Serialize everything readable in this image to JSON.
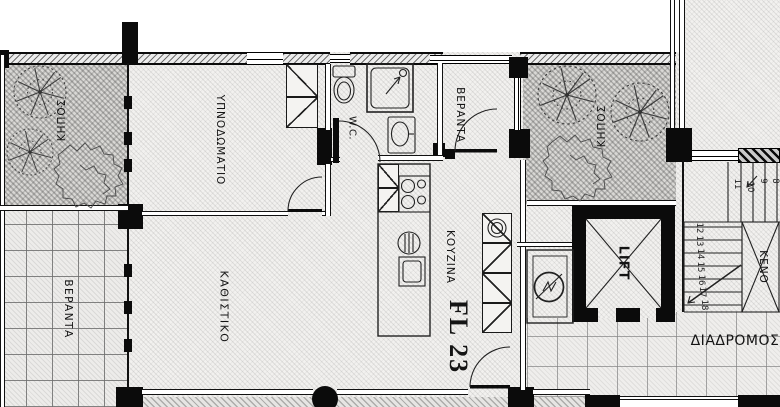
{
  "plan": {
    "unit_label": "FL 23",
    "rooms": {
      "garden_left": "ΚΗΠΟΣ",
      "garden_right": "ΚΗΠΟΣ",
      "bedroom": "ΥΠΝΟΔΩΜΑΤΙΟ",
      "veranda_left": "ΒΕΡΑΝΤΑ",
      "veranda_top": "ΒΕΡΑΝΤΑ",
      "living": "ΚΑΘΙΣΤΙΚΟ",
      "wc": "W.C.",
      "kitchen": "ΚΟΥΖΙΝΑ",
      "lift": "LIFT",
      "void": "ΚΕΝΟ",
      "corridor": "ΔΙΑΔΡΟΜΟΣ"
    },
    "stairs": {
      "upper_flight": [
        "11",
        "10",
        "9",
        "8"
      ],
      "lower_flight": [
        "12",
        "13",
        "14",
        "15",
        "16",
        "17",
        "18"
      ]
    },
    "colors": {
      "ink": "#141414",
      "wall_black": "#0b0b0b",
      "floor_base": "#f2f1ef",
      "garden_base": "#d9d8d5",
      "tile_base": "#edecea"
    }
  }
}
